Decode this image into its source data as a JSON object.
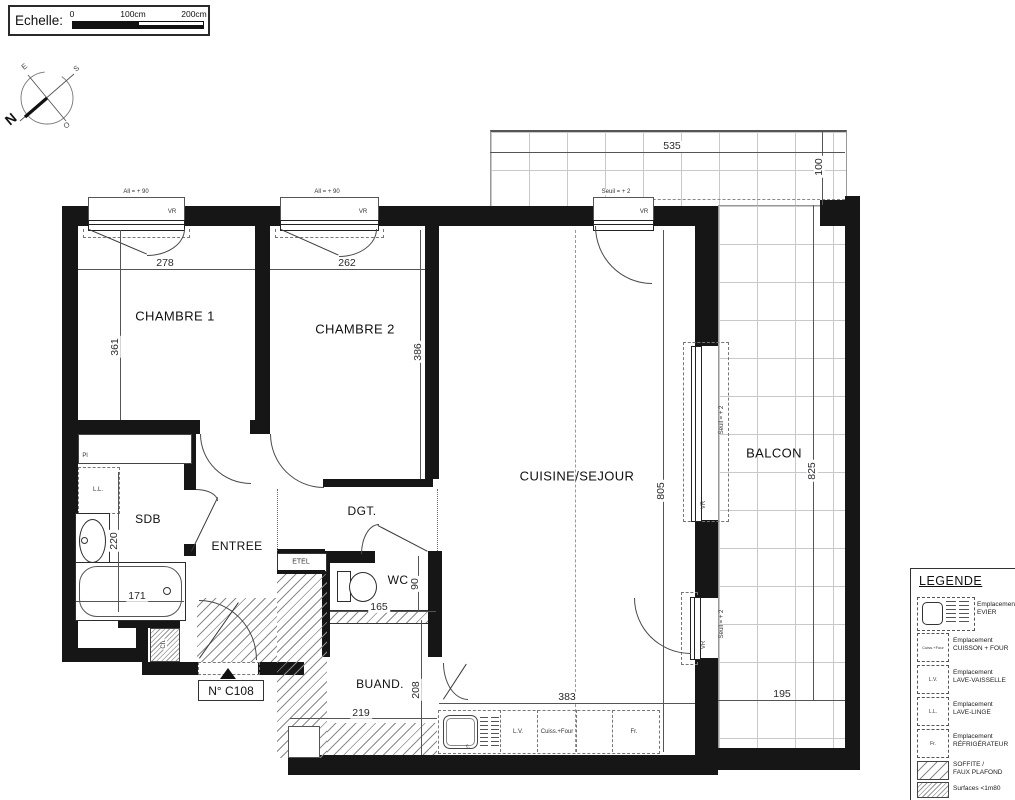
{
  "scale_bar": {
    "label": "Echelle:",
    "ticks": [
      "0",
      "100cm",
      "200cm"
    ]
  },
  "compass": {
    "n": "N",
    "e": "E",
    "s": "S",
    "o": "O"
  },
  "plan": {
    "unit_number": "N° C108",
    "rooms": {
      "chambre1": "CHAMBRE 1",
      "chambre2": "CHAMBRE 2",
      "cuisine": "CUISINE/SEJOUR",
      "balcon": "BALCON",
      "sdb": "SDB",
      "entree": "ENTREE",
      "dgt": "DGT.",
      "wc": "WC",
      "buand": "BUAND.",
      "etel": "ETEL"
    },
    "dims": {
      "chambre1_w": "278",
      "chambre2_w": "262",
      "chambre1_h": "361",
      "chambre2_h": "386",
      "balcon_top_w": "535",
      "balcon_top_d": "100",
      "balcon_h": "825",
      "balcon_w": "195",
      "cuisine_h": "805",
      "cuisine_w": "383",
      "sdb_h": "220",
      "bath_w": "171",
      "wc_h": "90",
      "wc_w": "165",
      "buand_h": "208",
      "buand_w": "219"
    },
    "annotations": {
      "allege": "All = + 90",
      "vr": "VR",
      "seuil": "Seuil = + 2",
      "pl": "Pl",
      "lave_linge": "L.L.",
      "chauffe": "Ch.",
      "robinet": "c.",
      "lave_vaisselle": "L.V.",
      "cuisson_four": "Cuiss.+Four",
      "frigo": "Fr."
    }
  },
  "legend": {
    "title": "LEGENDE",
    "items": [
      {
        "icon": "evier",
        "label": "Emplacement\nEVIER"
      },
      {
        "icon": "cuisson-four",
        "box": "Cuiss.+Four",
        "label": "Emplacement\nCUISSON + FOUR"
      },
      {
        "icon": "lave-vaisselle",
        "box": "L.V.",
        "label": "Emplacement\nLAVE-VAISSELLE"
      },
      {
        "icon": "lave-linge",
        "box": "L.L.",
        "label": "Emplacement\nLAVE-LINGE"
      },
      {
        "icon": "refrigerateur",
        "box": "Fr.",
        "label": "Emplacement\nRÉFRIGÉRATEUR"
      },
      {
        "icon": "soffite",
        "label": "SOFFITE /\nFAUX PLAFOND"
      },
      {
        "icon": "surfaces",
        "label": "Surfaces <1m80"
      }
    ]
  }
}
